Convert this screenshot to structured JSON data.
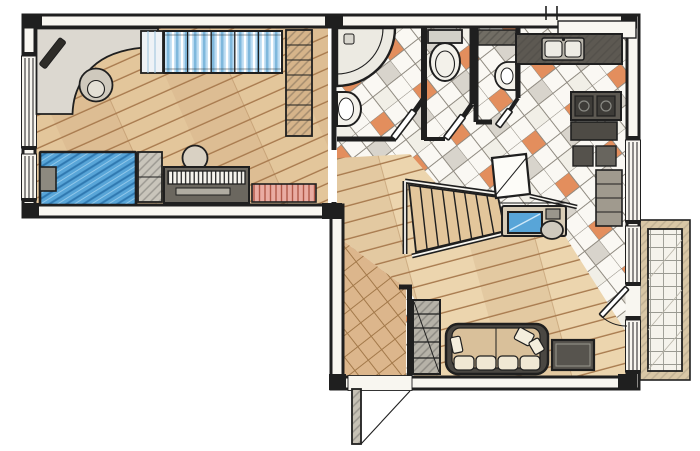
{
  "document": {
    "type": "hand-drawn-apartment-floor-plan",
    "canvas": {
      "width": 700,
      "height": 451
    },
    "style": "colored pencil architectural sketch, top-down plan view, no text labels"
  },
  "colors": {
    "ink": "#1f1f1f",
    "wallFill": "#f8f6f0",
    "paper": "#ffffff",
    "wood": "#e3c69b",
    "woodLight": "#ecd5ae",
    "woodLine": "#a87a4e",
    "tile": "#faf8f3",
    "tileLine": "#8f8a80",
    "tileOrange": "#e07f48",
    "tileGray": "#d2cec6",
    "entry": "#dcb68c",
    "entryLine": "#a3794a",
    "bed": "#58a5d8",
    "bedLine": "#2f78b0",
    "glass": "#bcdcf2",
    "glassLine": "#7fb8dc",
    "counterDark": "#5d5952",
    "counterMid": "#8b8377",
    "sofaTan": "#d9c09a",
    "sofaDark": "#4a4742",
    "cushion": "#f0e8d4",
    "rugDark": "#57544e",
    "shelfTan": "#d6b48a",
    "radiator": "#e9aca2",
    "radiatorLine": "#b05848",
    "chairGray": "#cfc9bd",
    "deskGray": "#dcd8d0",
    "fixture": "#f3f1ea",
    "balconyBorder": "#d9c7a6",
    "balconyLine": "#9a9a92",
    "landing": "#fdfcf8"
  },
  "rooms": [
    {
      "id": "study-bedroom",
      "floor": "diagonal-wood-planks",
      "features": [
        "corner-desk",
        "desk-lamp",
        "task-chair",
        "side-cabinet",
        "glass-door-wardrobe",
        "bookshelf",
        "double-bed-blue",
        "bedside-shelf",
        "cabinet-by-bed",
        "piano",
        "piano-stool",
        "radiator"
      ],
      "windows": 2,
      "doorway": "open-to-hall"
    },
    {
      "id": "bathroom",
      "floor": "white-tile-orange-accents",
      "features": [
        "corner-shower",
        "washbasin",
        "angled-door"
      ]
    },
    {
      "id": "wc",
      "floor": "white-tile-orange-accents",
      "features": [
        "toilet-with-tank",
        "angled-door"
      ]
    },
    {
      "id": "utility",
      "floor": "white-tile-orange-accents",
      "features": [
        "wall-shelf",
        "small-washbasin",
        "angled-door"
      ]
    },
    {
      "id": "kitchen",
      "floor": "white-tile-orange-accents",
      "features": [
        "counter-with-double-sink",
        "vent-shaft",
        "stove-two-burners",
        "lower-counter",
        "appliance-squares",
        "side-table"
      ],
      "windows": 1
    },
    {
      "id": "hall",
      "floor": "white-tile-orange-accents",
      "features": [
        "staircase-up",
        "stair-railing",
        "stair-landing",
        "handrail",
        "desk-with-monitor",
        "desk-chair"
      ]
    },
    {
      "id": "entry-corridor",
      "floor": "terracotta-tile-grid",
      "features": [
        "entrance-door-outswing",
        "shelving-unit"
      ]
    },
    {
      "id": "living-room",
      "floor": "diagonal-wood-planks",
      "features": [
        "sofa-with-cushions",
        "throw-pillows",
        "dark-rug",
        "balcony-door"
      ],
      "windows": 2
    },
    {
      "id": "balcony",
      "floor": "grid-tile-deck",
      "features": [
        "perimeter-wall"
      ]
    }
  ]
}
